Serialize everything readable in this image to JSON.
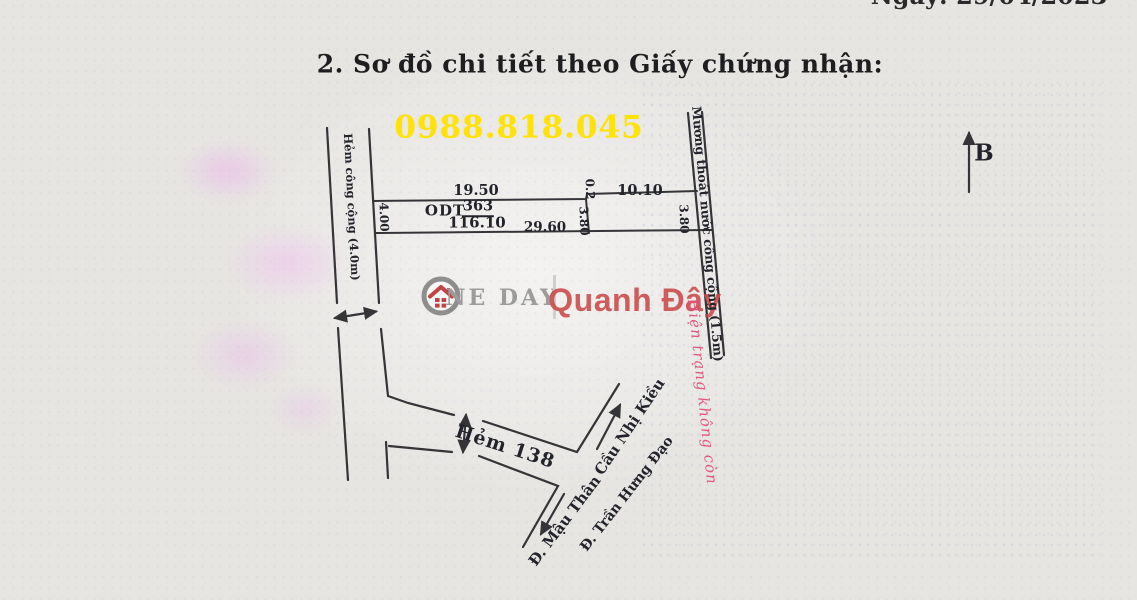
{
  "page": {
    "date_top": "Ngày: 29/04/2023",
    "section_title": "2.  Sơ đồ chi tiết theo Giấy chứng nhận:",
    "phone": "0988.818.045"
  },
  "watermark": {
    "brand_left": "NE DAY",
    "brand_right": "Quanh Đây",
    "icon": "house-circle-icon",
    "brand_left_color": "#9c9c9c",
    "brand_right_color": "#c94848"
  },
  "diagram": {
    "north_label": "B",
    "roads": {
      "left_alley": "Hẻm công cộng (4.0m)",
      "drain_channel": "Mương thoát nước công cộng (1.5m)",
      "alley_138": "Hẻm 138",
      "bridge": "Cầu Nhị Kiều",
      "street_tran_hung_dao": "Đ. Trần Hưng Đạo",
      "street_mau_than": "Đ. Mậu Thân"
    },
    "parcel": {
      "zone_code": "ODT",
      "lot_number": "363",
      "area": "116.10",
      "dims": {
        "top_left": "19.50",
        "top_jog": "0.2",
        "top_right": "10.10",
        "bottom": "29.60",
        "left": "4.00",
        "middle": "3.80",
        "right": "3.80"
      }
    },
    "note_red": "Hiện trạng không còn",
    "note_color": "#e2517c",
    "phone_color": "#ffe20a"
  }
}
